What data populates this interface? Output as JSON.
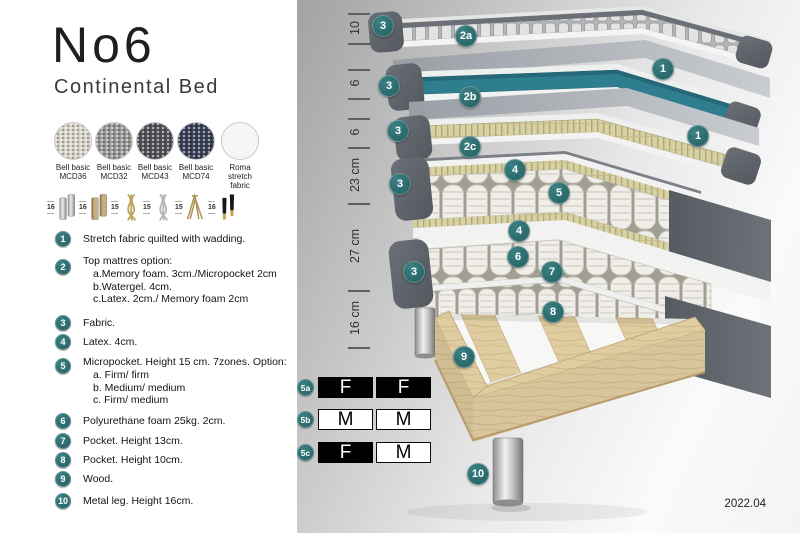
{
  "header": {
    "title": "No6",
    "subtitle": "Continental Bed"
  },
  "fabrics": [
    {
      "name": "Bell basic",
      "code": "MCD36",
      "color": "#d9d4c8"
    },
    {
      "name": "Bell basic",
      "code": "MCD32",
      "color": "#999997"
    },
    {
      "name": "Bell basic",
      "code": "MCD43",
      "color": "#53555b"
    },
    {
      "name": "Bell basic",
      "code": "MCD74",
      "color": "#3b4158"
    },
    {
      "name": "Roma",
      "code": "stretch fabric",
      "color": "#f6f6f6"
    }
  ],
  "leg_options": [
    {
      "height": "16",
      "style": "cylinder-silver"
    },
    {
      "height": "16",
      "style": "cylinder-brass"
    },
    {
      "height": "15",
      "style": "twisted-gold"
    },
    {
      "height": "15",
      "style": "twisted-silver"
    },
    {
      "height": "15",
      "style": "hairpin-gold"
    },
    {
      "height": "16",
      "style": "tapered-black-gold"
    }
  ],
  "legend": [
    {
      "num": "1",
      "lines": [
        "Stretch fabric quilted with wadding."
      ]
    },
    {
      "num": "2",
      "lines": [
        "Top mattres option:",
        "a.Memory foam. 3cm./Micropocket 2cm",
        "b.Watergel. 4cm.",
        "c.Latex. 2cm./ Memory foam 2cm"
      ]
    },
    {
      "num": "3",
      "lines": [
        "Fabric."
      ]
    },
    {
      "num": "4",
      "lines": [
        "Latex. 4cm."
      ]
    },
    {
      "num": "5",
      "lines": [
        "Micropocket. Height 15 cm. 7zones. Option:",
        "a. Firm/ firm",
        "b. Medium/ medium",
        "c. Firm/ medium"
      ]
    },
    {
      "num": "6",
      "lines": [
        "Polyurethane foam 25kg. 2cm."
      ]
    },
    {
      "num": "7",
      "lines": [
        "Pocket. Height 13cm."
      ]
    },
    {
      "num": "8",
      "lines": [
        "Pocket. Height 10cm."
      ]
    },
    {
      "num": "9",
      "lines": [
        "Wood."
      ]
    },
    {
      "num": "10",
      "lines": [
        "Metal leg. Height 16cm."
      ]
    }
  ],
  "ruler": {
    "labels": [
      "10",
      "6",
      "6",
      "23 cm",
      "27 cm",
      "16 cm"
    ]
  },
  "diagram": {
    "badges": [
      "3",
      "2a",
      "1",
      "3",
      "2b",
      "1",
      "3",
      "2c",
      "4",
      "3",
      "5",
      "4",
      "6",
      "3",
      "7",
      "8",
      "9",
      "10"
    ]
  },
  "firmness": [
    {
      "id": "5a",
      "cells": [
        {
          "letter": "F",
          "fill": "black"
        },
        {
          "letter": "F",
          "fill": "black"
        }
      ]
    },
    {
      "id": "5b",
      "cells": [
        {
          "letter": "M",
          "fill": "white"
        },
        {
          "letter": "M",
          "fill": "white"
        }
      ]
    },
    {
      "id": "5c",
      "cells": [
        {
          "letter": "F",
          "fill": "black"
        },
        {
          "letter": "M",
          "fill": "white"
        }
      ]
    }
  ],
  "version": "2022.04",
  "colors": {
    "badge_teal": "#2e6f70",
    "core_teal": "#2f7e8f",
    "fabric_gray": "#5d6269",
    "wood": "#ddca9e"
  }
}
